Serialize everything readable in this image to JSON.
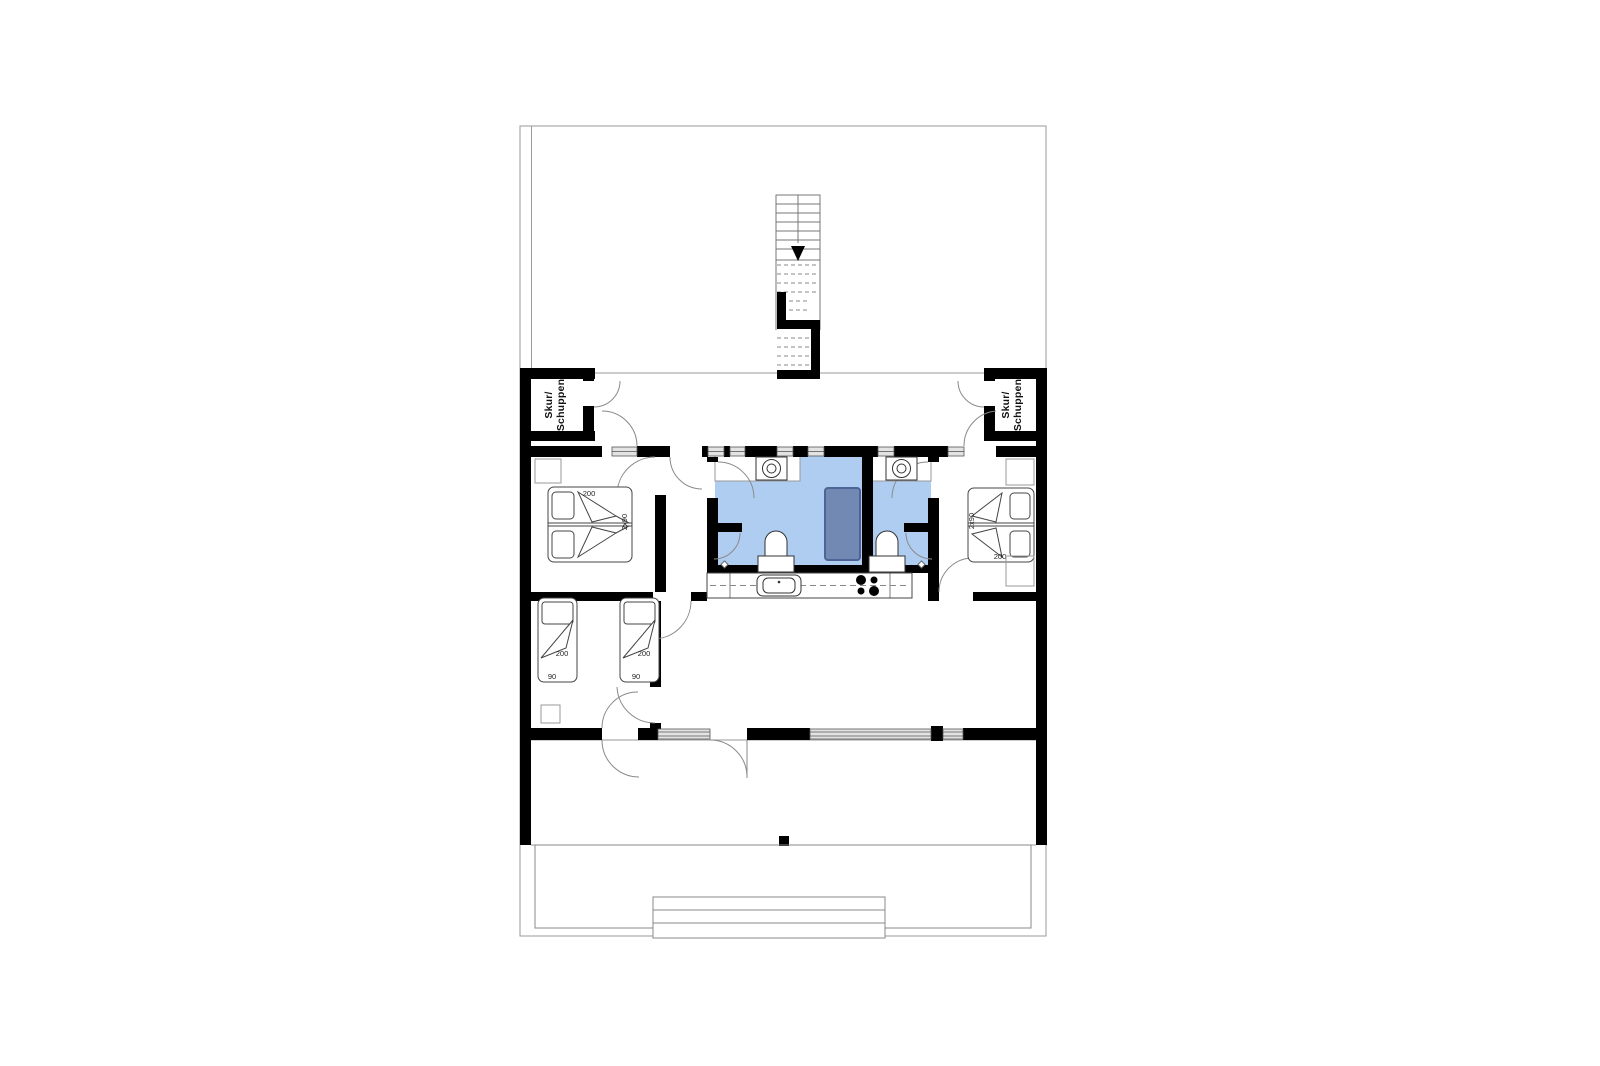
{
  "plan": {
    "type": "floor-plan",
    "sheds": {
      "left": {
        "line1": "Skur/",
        "line2": "Schuppen"
      },
      "right": {
        "line1": "Skur/",
        "line2": "Schuppen"
      }
    },
    "beds": {
      "double_left": {
        "length": "200",
        "width": "2x90"
      },
      "double_right": {
        "length": "200",
        "width": "2x90"
      },
      "single_left": {
        "length": "200",
        "width": "90"
      },
      "single_right": {
        "length": "200",
        "width": "90"
      }
    },
    "colors": {
      "wall": "#000000",
      "thin_line": "#8a8a8a",
      "bath_fill": "#aecdf1",
      "tub_fill": "#7289b4",
      "tub_border": "#4d6596",
      "window_fill": "#e3e3e3"
    }
  }
}
